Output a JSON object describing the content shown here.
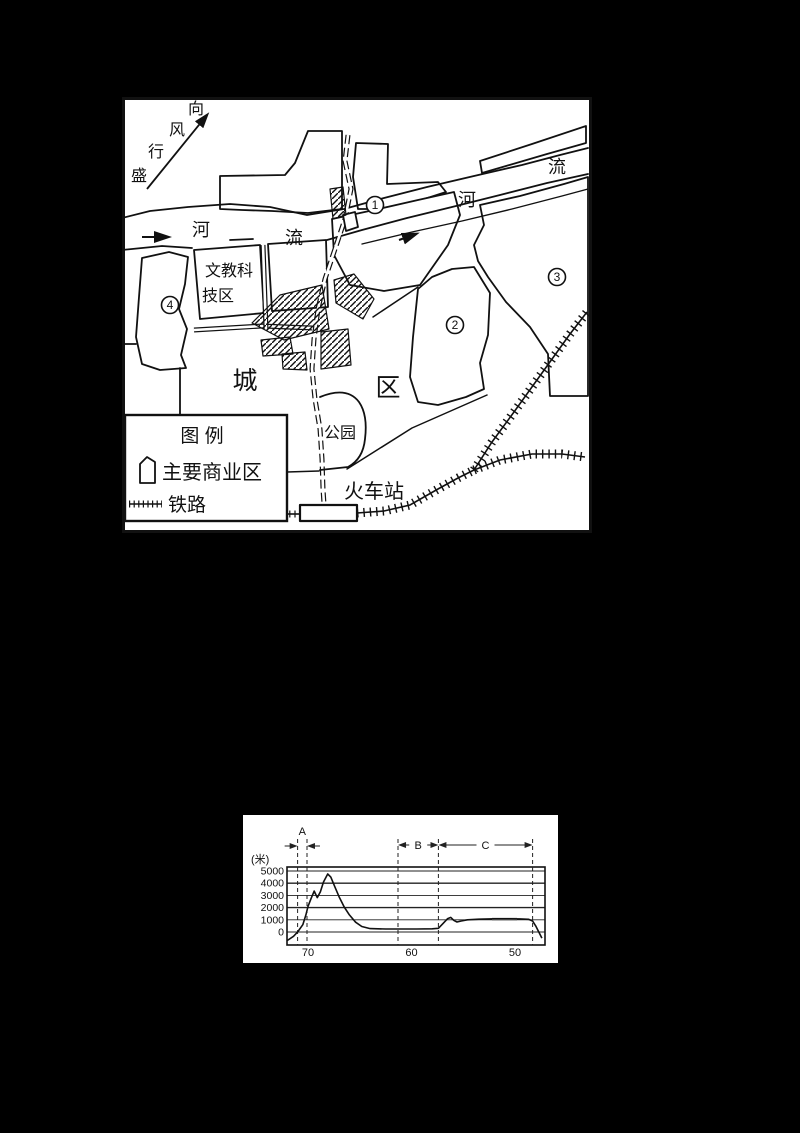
{
  "page": {
    "background": "#000000",
    "panel_background": "#ffffff",
    "ink": "#111111"
  },
  "map": {
    "wind": {
      "full": "盛行风向",
      "chars": [
        "盛",
        "行",
        "风",
        "向"
      ]
    },
    "river": {
      "left": {
        "he": "河",
        "liu": "流"
      },
      "right": {
        "he": "河",
        "liu": "流"
      }
    },
    "districts": [
      {
        "digit": "1",
        "label": "①"
      },
      {
        "digit": "2",
        "label": "②"
      },
      {
        "digit": "3",
        "label": "③"
      },
      {
        "digit": "4",
        "label": "④"
      }
    ],
    "edu_zone": {
      "full": "文教科技区",
      "line1": "文教科",
      "line2": "技区"
    },
    "city": {
      "cheng": "城",
      "qu": "区"
    },
    "park_label": "公园",
    "station_label": "火车站",
    "legend": {
      "title": "图  例",
      "items": [
        {
          "symbol": "commercial-area-polygon",
          "label": "主要商业区"
        },
        {
          "symbol": "railway-ticks",
          "label": "铁路"
        }
      ]
    }
  },
  "chart_data": {
    "type": "line",
    "ylabel": "(米)",
    "yticks": [
      0,
      1000,
      2000,
      3000,
      4000,
      5000
    ],
    "xticks": [
      70,
      60,
      50
    ],
    "x_reversed": true,
    "ylim": [
      -1000,
      5000
    ],
    "grid": true,
    "regions": [
      {
        "label": "A",
        "from": 71.0,
        "to": 70.1
      },
      {
        "label": "B",
        "from": 61.3,
        "to": 57.4
      },
      {
        "label": "C",
        "from": 57.4,
        "to": 48.3
      }
    ],
    "profile_points": [
      [
        72.0,
        -700
      ],
      [
        71.4,
        -350
      ],
      [
        71.0,
        0
      ],
      [
        70.5,
        600
      ],
      [
        70.2,
        1400
      ],
      [
        70.0,
        2100
      ],
      [
        69.7,
        2750
      ],
      [
        69.4,
        3350
      ],
      [
        69.1,
        2820
      ],
      [
        68.8,
        3300
      ],
      [
        68.5,
        4100
      ],
      [
        68.1,
        4750
      ],
      [
        67.8,
        4500
      ],
      [
        67.4,
        3700
      ],
      [
        67.0,
        2900
      ],
      [
        66.5,
        2050
      ],
      [
        66.0,
        1400
      ],
      [
        65.4,
        800
      ],
      [
        64.8,
        450
      ],
      [
        64.0,
        280
      ],
      [
        62.5,
        250
      ],
      [
        61.0,
        250
      ],
      [
        59.5,
        250
      ],
      [
        58.0,
        260
      ],
      [
        57.4,
        300
      ],
      [
        57.0,
        650
      ],
      [
        56.5,
        1100
      ],
      [
        56.2,
        1200
      ],
      [
        55.9,
        950
      ],
      [
        55.6,
        820
      ],
      [
        55.2,
        900
      ],
      [
        54.6,
        1000
      ],
      [
        53.5,
        1050
      ],
      [
        52.0,
        1080
      ],
      [
        50.5,
        1080
      ],
      [
        49.5,
        1070
      ],
      [
        48.7,
        1040
      ],
      [
        48.3,
        900
      ],
      [
        48.0,
        500
      ],
      [
        47.7,
        0
      ],
      [
        47.4,
        -500
      ]
    ]
  }
}
